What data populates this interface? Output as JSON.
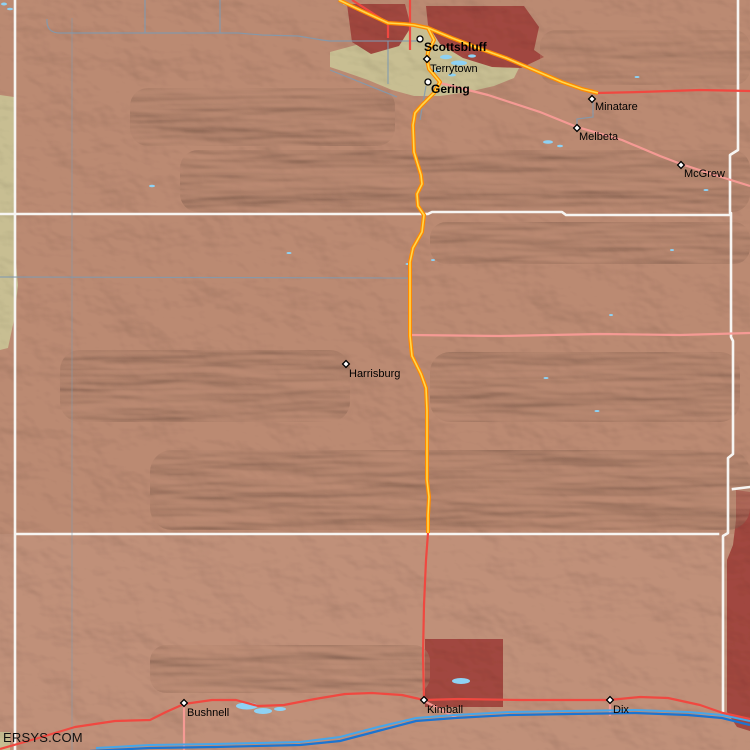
{
  "map": {
    "attribution": "ERSYS.COM",
    "towns": [
      {
        "name": "Scottsbluff",
        "marker": "circle",
        "bold": true,
        "x": 420,
        "y": 39,
        "lx": 424,
        "ly": 51
      },
      {
        "name": "Terrytown",
        "marker": "diamond",
        "bold": false,
        "x": 427,
        "y": 59,
        "lx": 430,
        "ly": 72
      },
      {
        "name": "Gering",
        "marker": "circle",
        "bold": true,
        "x": 428,
        "y": 82,
        "lx": 431,
        "ly": 93
      },
      {
        "name": "Minatare",
        "marker": "diamond",
        "bold": false,
        "x": 592,
        "y": 99,
        "lx": 595,
        "ly": 110
      },
      {
        "name": "Melbeta",
        "marker": "diamond",
        "bold": false,
        "x": 577,
        "y": 128,
        "lx": 579,
        "ly": 140
      },
      {
        "name": "McGrew",
        "marker": "diamond",
        "bold": false,
        "x": 681,
        "y": 165,
        "lx": 684,
        "ly": 177
      },
      {
        "name": "Harrisburg",
        "marker": "diamond",
        "bold": false,
        "x": 346,
        "y": 364,
        "lx": 349,
        "ly": 377
      },
      {
        "name": "Bushnell",
        "marker": "diamond",
        "bold": false,
        "x": 184,
        "y": 703,
        "lx": 187,
        "ly": 716
      },
      {
        "name": "Kimball",
        "marker": "diamond",
        "bold": false,
        "x": 424,
        "y": 700,
        "lx": 427,
        "ly": 713
      },
      {
        "name": "Dix",
        "marker": "diamond",
        "bold": false,
        "x": 610,
        "y": 700,
        "lx": 613,
        "ly": 713
      }
    ],
    "colors": {
      "terrain": "#bb8a72",
      "terrain_south": "#c09079",
      "valley_tan": "#c8be92",
      "urban_red": "#a1473f",
      "county_line": "#f7f5f2",
      "road_minor": "#7f9ab0",
      "road_pink": "#f59a94",
      "road_red": "#f04840",
      "road_orange": "#ff8a00",
      "road_yellow": "#ffd84d",
      "water_light": "#8ed2f4",
      "interstate_light": "#48a6e8",
      "interstate_dark": "#1c74d0"
    }
  }
}
